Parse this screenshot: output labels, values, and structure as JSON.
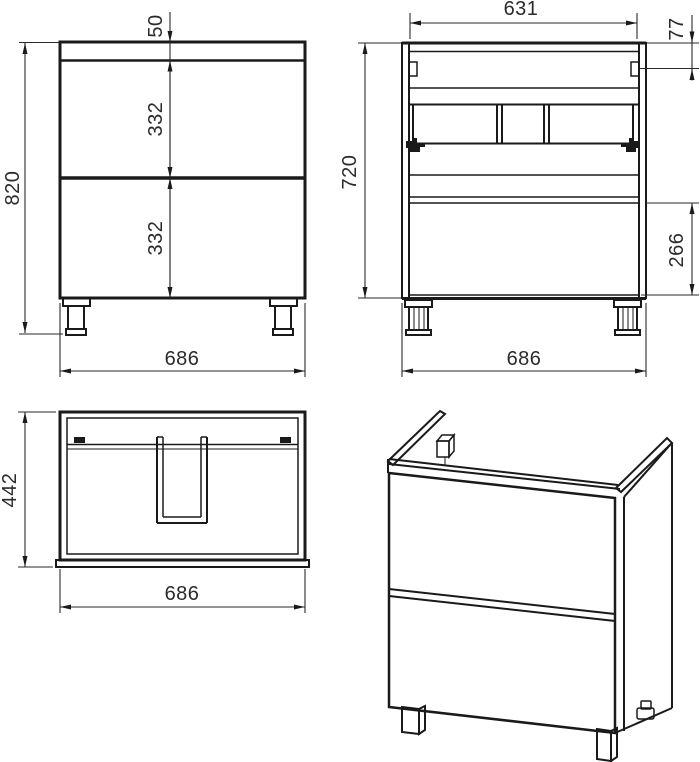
{
  "colors": {
    "ink": "#1a1a1a",
    "paper": "#ffffff"
  },
  "views": {
    "front": {
      "overall_height": "820",
      "top_rail": "50",
      "upper_drawer": "332",
      "lower_drawer": "332",
      "overall_width": "686"
    },
    "back": {
      "inner_width": "631",
      "mount_offset": "77",
      "carcass_height": "720",
      "lower_panel": "266",
      "overall_width": "686"
    },
    "top": {
      "depth": "442",
      "overall_width": "686"
    }
  }
}
